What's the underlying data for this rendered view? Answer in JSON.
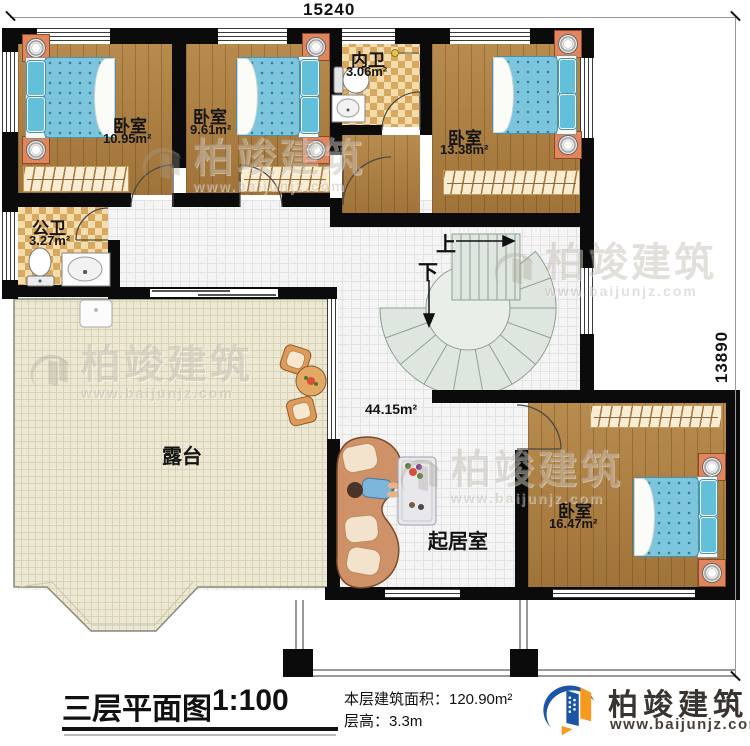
{
  "dimensions": {
    "top": "15240",
    "right": "13890"
  },
  "rooms": [
    {
      "name": "卧室",
      "area": "10.95m²"
    },
    {
      "name": "卧室",
      "area": "9.61m²"
    },
    {
      "name": "内卫",
      "area": "3.06m²"
    },
    {
      "name": "卧室",
      "area": "13.38m²"
    },
    {
      "name": "公卫",
      "area": "3.27m²"
    },
    {
      "name": "露台",
      "area": ""
    },
    {
      "name": "起居室",
      "area": "44.15m²"
    },
    {
      "name": "卧室",
      "area": "16.47m²"
    }
  ],
  "stairs": {
    "up": "上",
    "down": "下"
  },
  "footer": {
    "title": "三层平面图",
    "scale": "1:100",
    "area_line": "本层建筑面积：120.90m²",
    "height_line": "层高：3.3m"
  },
  "brand": {
    "name": "柏竣建筑",
    "url": "www.baijunjz.com"
  },
  "watermark": {
    "name": "柏竣建筑",
    "url": "www.baijunjz.com"
  },
  "colors": {
    "brand_blue": "#1c55a4",
    "brand_orange": "#f59a1d",
    "wall": "#0b0b0b",
    "wood": "#b2813f",
    "mattress_blue": "#7cc5dc",
    "terrace": "#ece8d3",
    "stair_fill": "#dfe6e0"
  }
}
